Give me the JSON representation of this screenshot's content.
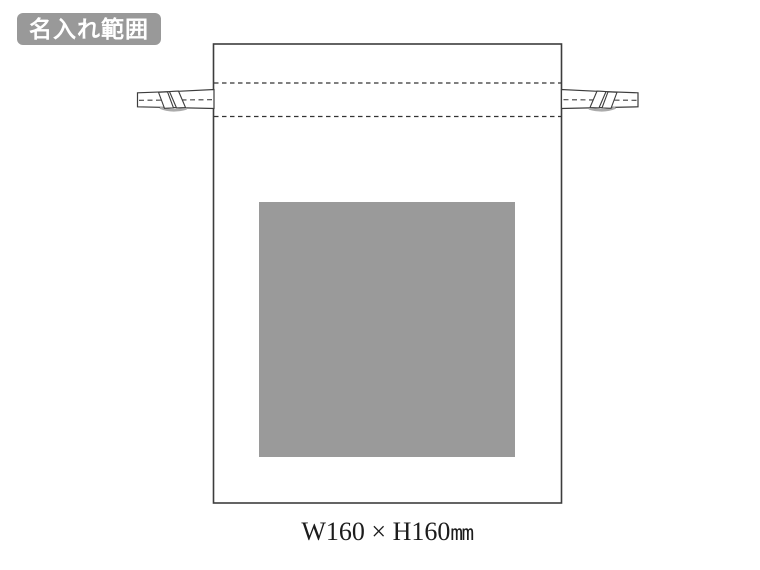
{
  "badge": {
    "label": "名入れ範囲"
  },
  "dimensions": {
    "size": "W160 × H160",
    "unit": "mm"
  },
  "colors": {
    "badge_bg": "#999999",
    "badge_text": "#FFFFFF",
    "print_area_fill": "#9A9A9A",
    "line": "#3D3D3D",
    "dash_line": "#333333",
    "knot_shadow": "#ABABAB"
  }
}
